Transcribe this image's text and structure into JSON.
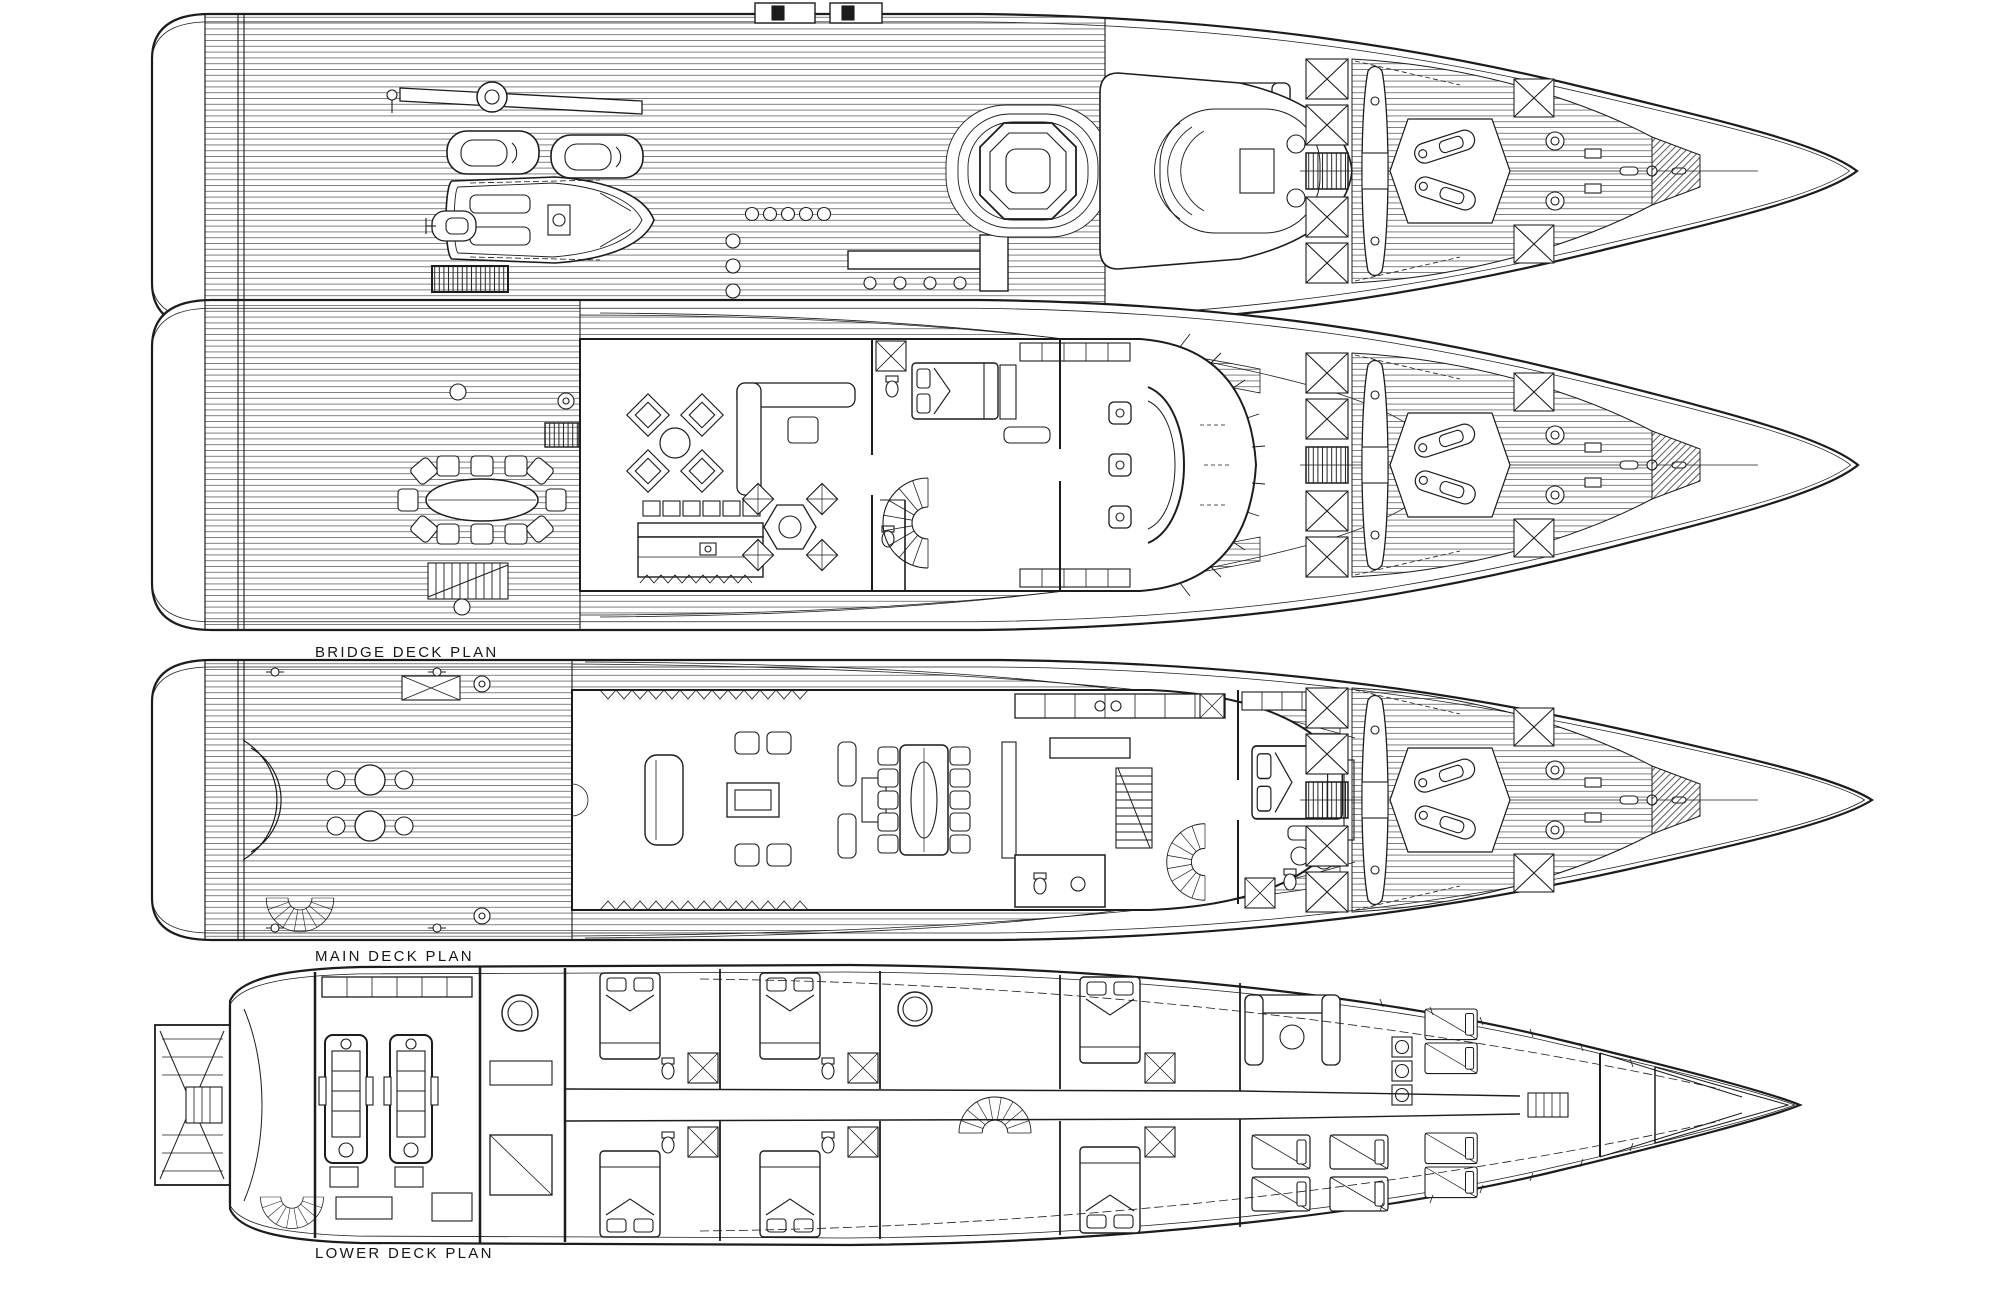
{
  "page": {
    "title": "Yacht General Arrangement Deck Plans",
    "background": "#ffffff",
    "ink_color": "#1c1c1c"
  },
  "decks": [
    {
      "id": "sun-deck",
      "label": "SUN DECK PLAN"
    },
    {
      "id": "bridge-deck",
      "label": "BRIDGE DECK PLAN"
    },
    {
      "id": "main-deck",
      "label": "MAIN DECK PLAN"
    },
    {
      "id": "lower-deck",
      "label": "LOWER DECK PLAN"
    }
  ]
}
